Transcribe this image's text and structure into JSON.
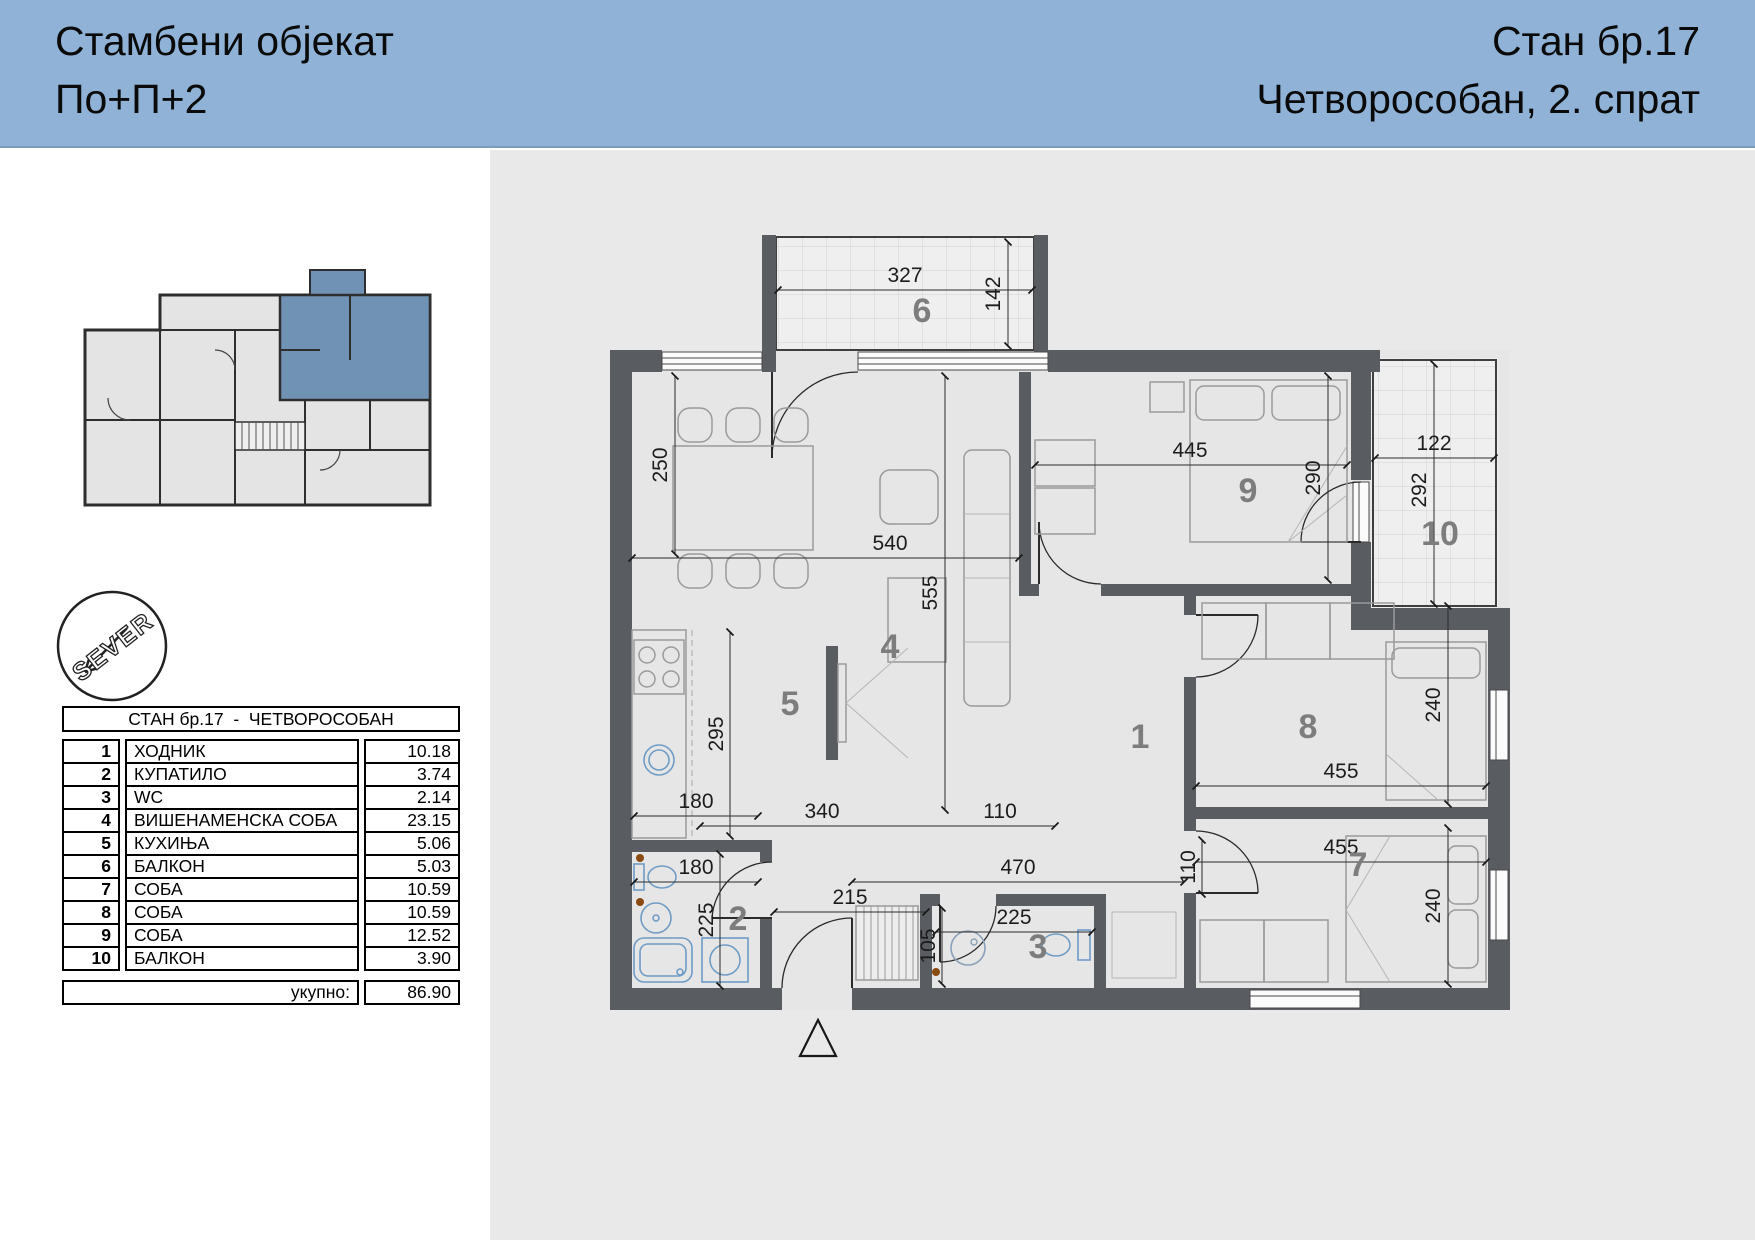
{
  "header": {
    "building_title_line1": "Стамбени објекат",
    "building_title_line2": "По+П+2",
    "apartment_line1": "Стан бр.17",
    "apartment_line2": "Четворособан, 2. спрат"
  },
  "colors": {
    "header_blue": "#8fb2d6",
    "unit_highlight_blue": "#7093b5",
    "wall_gray": "#595c60",
    "page_gray": "#e9e9e9",
    "fixture_blue": "#6f9cc5"
  },
  "stamp": {
    "text": "SEVER"
  },
  "table": {
    "title": "СТАН бр.17  -  ЧЕТВОРОСОБАН",
    "rows": [
      {
        "num": "1",
        "name": "ХОДНИК",
        "area": "10.18"
      },
      {
        "num": "2",
        "name": "КУПАТИЛО",
        "area": "3.74"
      },
      {
        "num": "3",
        "name": "WC",
        "area": "2.14"
      },
      {
        "num": "4",
        "name": "ВИШЕНАМЕНСКА СОБА",
        "area": "23.15"
      },
      {
        "num": "5",
        "name": "КУХИЊА",
        "area": "5.06"
      },
      {
        "num": "6",
        "name": "БАЛКОН",
        "area": "5.03"
      },
      {
        "num": "7",
        "name": "СОБА",
        "area": "10.59"
      },
      {
        "num": "8",
        "name": "СОБА",
        "area": "10.59"
      },
      {
        "num": "9",
        "name": "СОБА",
        "area": "12.52"
      },
      {
        "num": "10",
        "name": "БАЛКОН",
        "area": "3.90"
      }
    ],
    "total_label": "укупно:",
    "total_value": "86.90"
  },
  "plan": {
    "room_labels": [
      {
        "n": "1",
        "x": 650,
        "y": 598
      },
      {
        "n": "2",
        "x": 248,
        "y": 780
      },
      {
        "n": "3",
        "x": 548,
        "y": 808
      },
      {
        "n": "4",
        "x": 400,
        "y": 508
      },
      {
        "n": "5",
        "x": 300,
        "y": 565
      },
      {
        "n": "6",
        "x": 432,
        "y": 172
      },
      {
        "n": "7",
        "x": 868,
        "y": 726
      },
      {
        "n": "8",
        "x": 818,
        "y": 588
      },
      {
        "n": "9",
        "x": 758,
        "y": 352
      },
      {
        "n": "10",
        "x": 950,
        "y": 395
      }
    ],
    "dimensions": [
      {
        "v": "327",
        "x": 415,
        "y": 132,
        "r": 0
      },
      {
        "v": "142",
        "x": 510,
        "y": 144,
        "r": -90
      },
      {
        "v": "540",
        "x": 400,
        "y": 400,
        "r": 0
      },
      {
        "v": "250",
        "x": 177,
        "y": 315,
        "r": -90
      },
      {
        "v": "445",
        "x": 700,
        "y": 307,
        "r": 0
      },
      {
        "v": "290",
        "x": 830,
        "y": 328,
        "r": -90
      },
      {
        "v": "122",
        "x": 944,
        "y": 300,
        "r": 0
      },
      {
        "v": "292",
        "x": 936,
        "y": 340,
        "r": -90
      },
      {
        "v": "555",
        "x": 447,
        "y": 443,
        "r": -90
      },
      {
        "v": "295",
        "x": 233,
        "y": 584,
        "r": -90
      },
      {
        "v": "180",
        "x": 206,
        "y": 658,
        "r": 0
      },
      {
        "v": "340",
        "x": 332,
        "y": 668,
        "r": 0
      },
      {
        "v": "110",
        "x": 510,
        "y": 668,
        "r": 0
      },
      {
        "v": "455",
        "x": 851,
        "y": 628,
        "r": 0
      },
      {
        "v": "240",
        "x": 950,
        "y": 555,
        "r": -90
      },
      {
        "v": "180",
        "x": 206,
        "y": 724,
        "r": 0
      },
      {
        "v": "225",
        "x": 223,
        "y": 770,
        "r": -90
      },
      {
        "v": "470",
        "x": 528,
        "y": 724,
        "r": 0
      },
      {
        "v": "110",
        "x": 705,
        "y": 717,
        "r": -90
      },
      {
        "v": "215",
        "x": 360,
        "y": 754,
        "r": 0
      },
      {
        "v": "225",
        "x": 524,
        "y": 774,
        "r": 0
      },
      {
        "v": "105",
        "x": 445,
        "y": 796,
        "r": -90
      },
      {
        "v": "455",
        "x": 851,
        "y": 704,
        "r": 0
      },
      {
        "v": "240",
        "x": 950,
        "y": 756,
        "r": -90
      }
    ]
  }
}
